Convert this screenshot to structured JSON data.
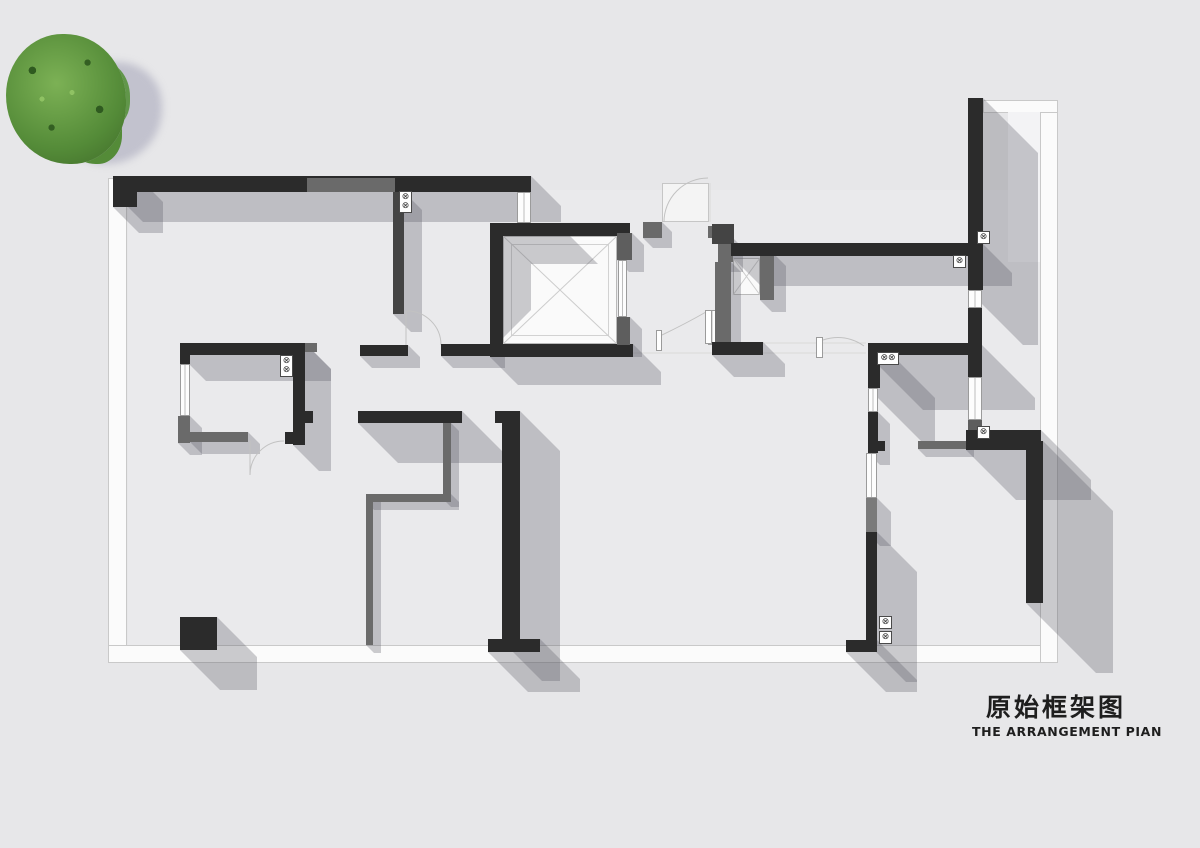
{
  "title": {
    "zh": "原始框架图",
    "en": "THE ARRANGEMENT PIAN"
  },
  "symbols": {
    "gas": "⊗"
  },
  "labels": {
    "tree": "tree-top-view",
    "elevator_shaft": "elevator-shaft",
    "duct": "duct-shaft"
  },
  "colors": {
    "wall": "#2b2b2b",
    "wall_gray": "#6a6a6a",
    "shadow": "rgba(88,88,98,0.30)",
    "background": "#e7e7e9",
    "tree_green": "#5d9140"
  }
}
